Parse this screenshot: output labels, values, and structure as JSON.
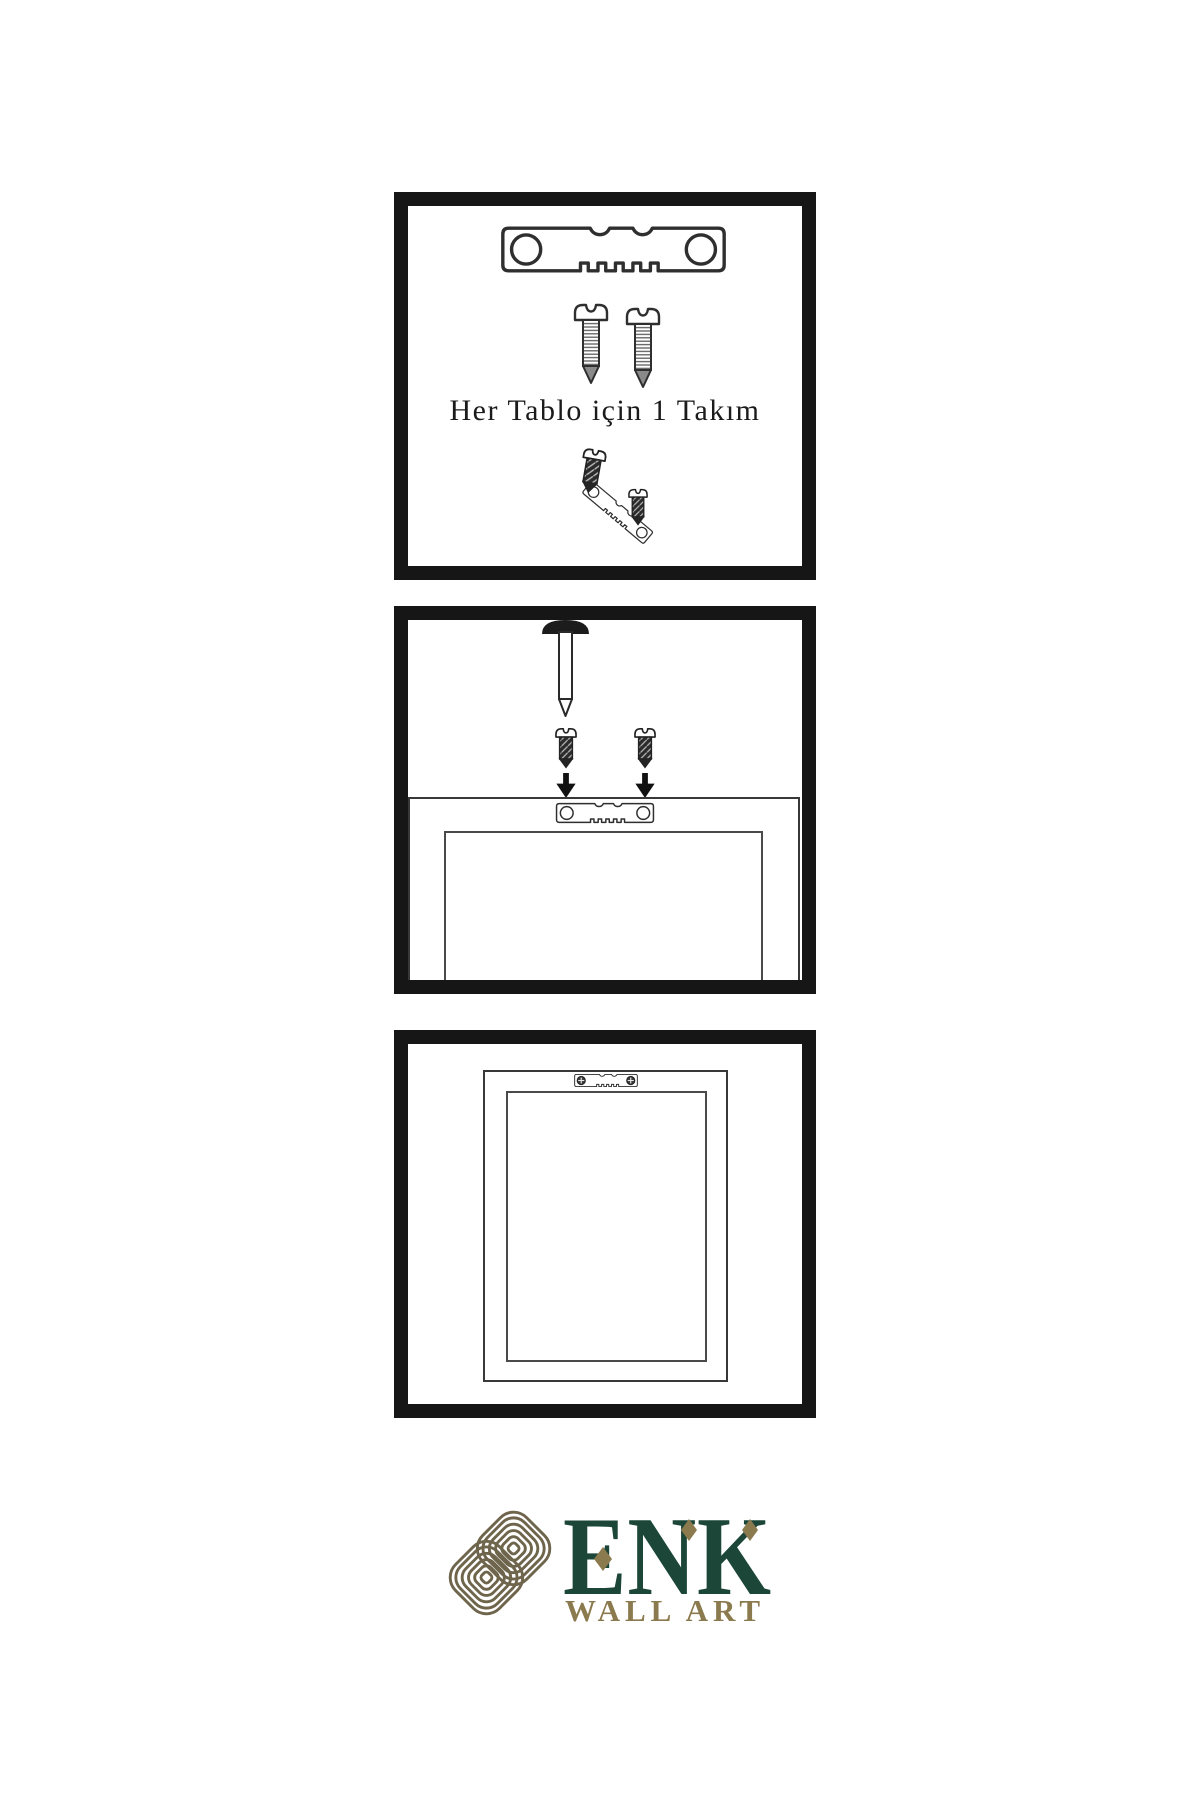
{
  "page": {
    "background": "#ffffff"
  },
  "colors": {
    "panel_border": "#161616",
    "line_art": "#2f2f2f",
    "screw_dark": "#2b2b2b",
    "logo_green": "#1c4638",
    "logo_gold": "#8c7a4f",
    "knot_gold": "#6e654c"
  },
  "panels": [
    {
      "id": "hardware-kit",
      "caption": "Her Tablo için 1 Takım",
      "icons": [
        "sawtooth-hanger-icon",
        "screw-icon",
        "screw-icon",
        "screw-into-hanger-icon"
      ]
    },
    {
      "id": "wall-mounting",
      "icons": [
        "nail-icon",
        "dark-screw-icon",
        "dark-screw-icon",
        "arrow-down-icon",
        "arrow-down-icon",
        "frame-back-with-hanger"
      ]
    },
    {
      "id": "mounted-frame-back",
      "icons": [
        "frame-back-with-hanger-installed"
      ]
    }
  ],
  "logo": {
    "name": "ENK",
    "subtitle": "WALL ART",
    "symbol": "interlocking-knot-icon"
  }
}
